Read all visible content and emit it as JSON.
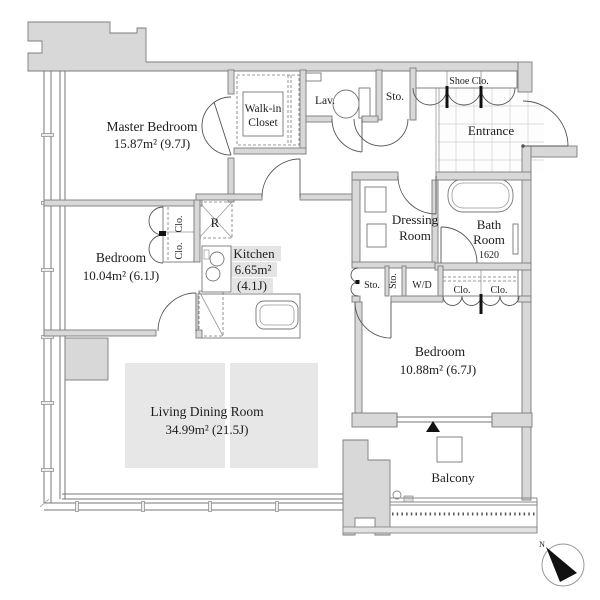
{
  "rooms": {
    "master_bedroom": {
      "name": "Master Bedroom",
      "area": "15.87m² (9.7J)"
    },
    "walk_in_closet": {
      "line1": "Walk-in",
      "line2": "Closet"
    },
    "lavatory": {
      "name": "Lav."
    },
    "storage_top": {
      "name": "Sto."
    },
    "shoe_closet": {
      "name": "Shoe Clo."
    },
    "entrance": {
      "name": "Entrance"
    },
    "dressing_room": {
      "line1": "Dressing",
      "line2": "Room"
    },
    "bath_room": {
      "line1": "Bath",
      "line2": "Room",
      "size": "1620"
    },
    "storage_small": {
      "name": "Sto."
    },
    "storage_tall": {
      "name": "Sto."
    },
    "washer_dryer": {
      "name": "W/D"
    },
    "closet_right_a": {
      "name": "Clo."
    },
    "closet_right_b": {
      "name": "Clo."
    },
    "closet_left_a": {
      "name": "Clo."
    },
    "closet_left_b": {
      "name": "Clo."
    },
    "refrigerator": {
      "name": "R"
    },
    "kitchen": {
      "name": "Kitchen",
      "area_m2": "6.65m²",
      "area_j": "(4.1J)"
    },
    "bedroom_left": {
      "name": "Bedroom",
      "area": "10.04m² (6.1J)"
    },
    "bedroom_right": {
      "name": "Bedroom",
      "area": "10.88m² (6.7J)"
    },
    "living_dining": {
      "name": "Living Dining Room",
      "area": "34.99m² (21.5J)"
    },
    "balcony": {
      "name": "Balcony"
    }
  },
  "compass": {
    "label": "N"
  },
  "colors": {
    "wall": "#d8d8d8",
    "line": "#777777",
    "text": "#1c1c1c",
    "highlight": "#e7e7e7"
  }
}
